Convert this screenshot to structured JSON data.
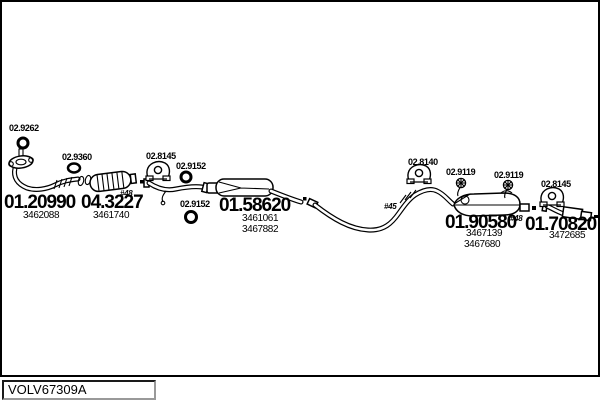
{
  "colors": {
    "ink": "#000000",
    "paper": "#ffffff",
    "frame_border": "#000000"
  },
  "footer": {
    "code": "VOLV67309A"
  },
  "assemblies": [
    {
      "name": "front-pipe",
      "number": "01.20990",
      "oe_numbers": [
        "3462088"
      ]
    },
    {
      "name": "catalytic-converter",
      "number": "04.3227",
      "oe_numbers": [
        "3461740"
      ]
    },
    {
      "name": "middle-muffler",
      "number": "01.58620",
      "oe_numbers": [
        "3461061",
        "3467882"
      ]
    },
    {
      "name": "rear-muffler",
      "number": "01.90580",
      "oe_numbers": [
        "3467139",
        "3467680"
      ]
    },
    {
      "name": "tail-muffler",
      "number": "01.70820",
      "oe_numbers": [
        "3472685"
      ]
    }
  ],
  "fittings": [
    {
      "number": "02.9262",
      "icon": "gasket-ring-icon"
    },
    {
      "number": "02.9360",
      "icon": "oval-gasket-icon"
    },
    {
      "number": "02.8145",
      "icon": "hanger-icon"
    },
    {
      "number": "02.9152",
      "icon": "ring-icon"
    },
    {
      "number": "02.9152",
      "icon": "ring-icon"
    },
    {
      "number": "02.8140",
      "icon": "hanger-icon"
    },
    {
      "number": "02.9119",
      "icon": "bolt-icon"
    },
    {
      "number": "02.9119",
      "icon": "bolt-icon"
    },
    {
      "number": "02.8145",
      "icon": "hanger-icon"
    }
  ],
  "notes": [
    "#48",
    "#45",
    "#48"
  ]
}
